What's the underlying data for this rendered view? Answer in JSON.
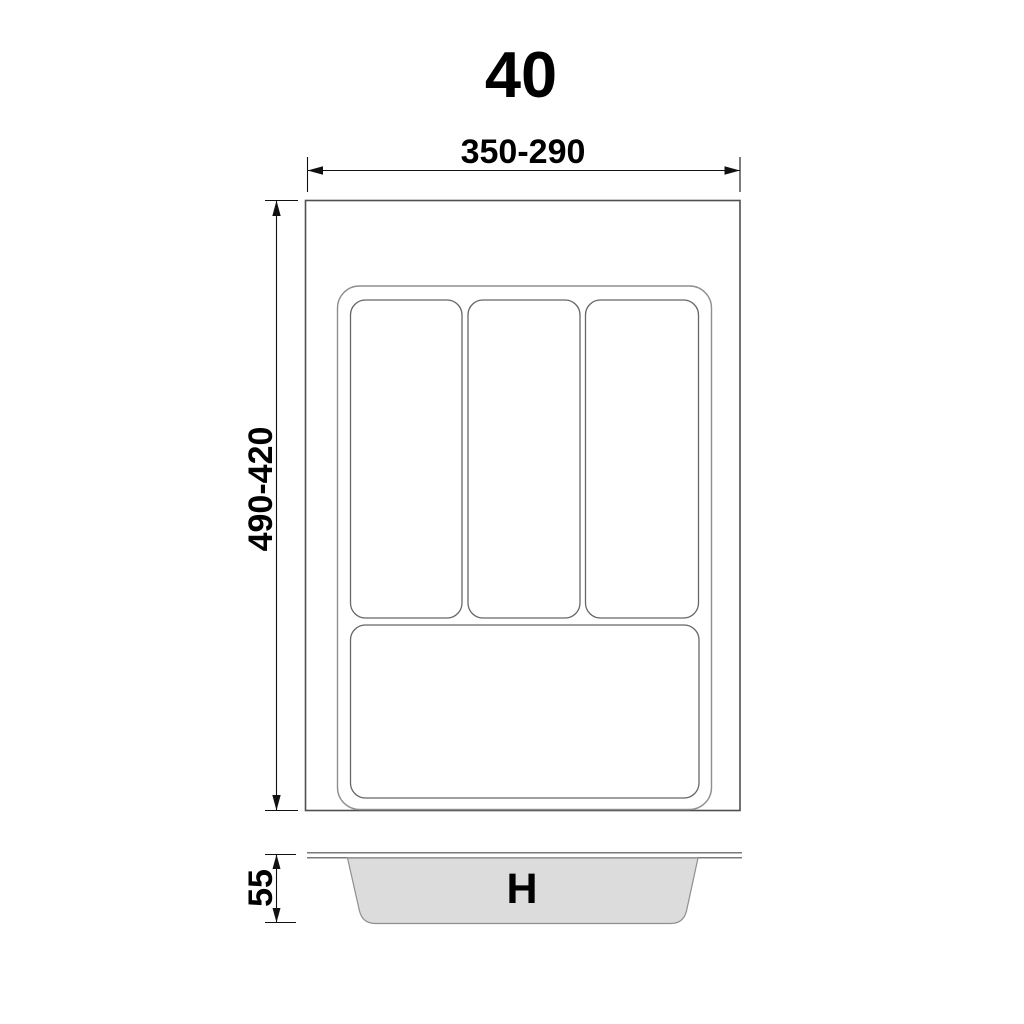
{
  "title": "40",
  "top_view": {
    "width_label": "350-290",
    "height_label": "490-420"
  },
  "side_view": {
    "height_label": "55",
    "tray_label": "H"
  },
  "colors": {
    "drawer_line": "#4f4f4f",
    "tray_line": "#8f8f8f",
    "compartment_line": "#666666",
    "dimension": "#111111",
    "text": "#000000",
    "tray_fill": "#dcdcdc"
  }
}
